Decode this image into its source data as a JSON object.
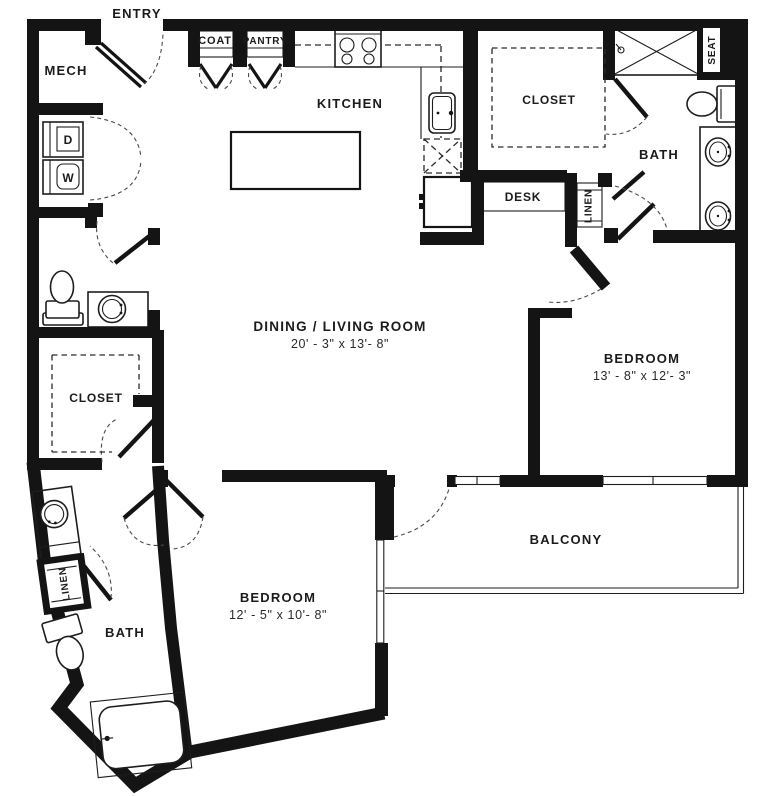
{
  "plan": {
    "title": "Two bedroom two bath apartment floor plan",
    "ink": "#141414",
    "rooms": {
      "entry": "ENTRY",
      "mech": "MECH",
      "coat": "COAT",
      "pantry": "PANTRY",
      "kitchen": "KITCHEN",
      "upper_closet": "CLOSET",
      "upper_bath": "BATH",
      "shower_seat": "SEAT",
      "desk": "DESK",
      "upper_linen": "LINEN",
      "dryer": "D",
      "washer": "W",
      "dining_living": {
        "name": "DINING / LIVING ROOM",
        "dims": "20' - 3\" x 13'- 8\""
      },
      "bedroom_right": {
        "name": "BEDROOM",
        "dims": "13' - 8\" x 12'- 3\""
      },
      "left_closet": "CLOSET",
      "balcony": "BALCONY",
      "bedroom_lower": {
        "name": "BEDROOM",
        "dims": "12' - 5\" x 10'- 8\""
      },
      "lower_bath": "BATH",
      "lower_linen": "LINEN"
    }
  }
}
